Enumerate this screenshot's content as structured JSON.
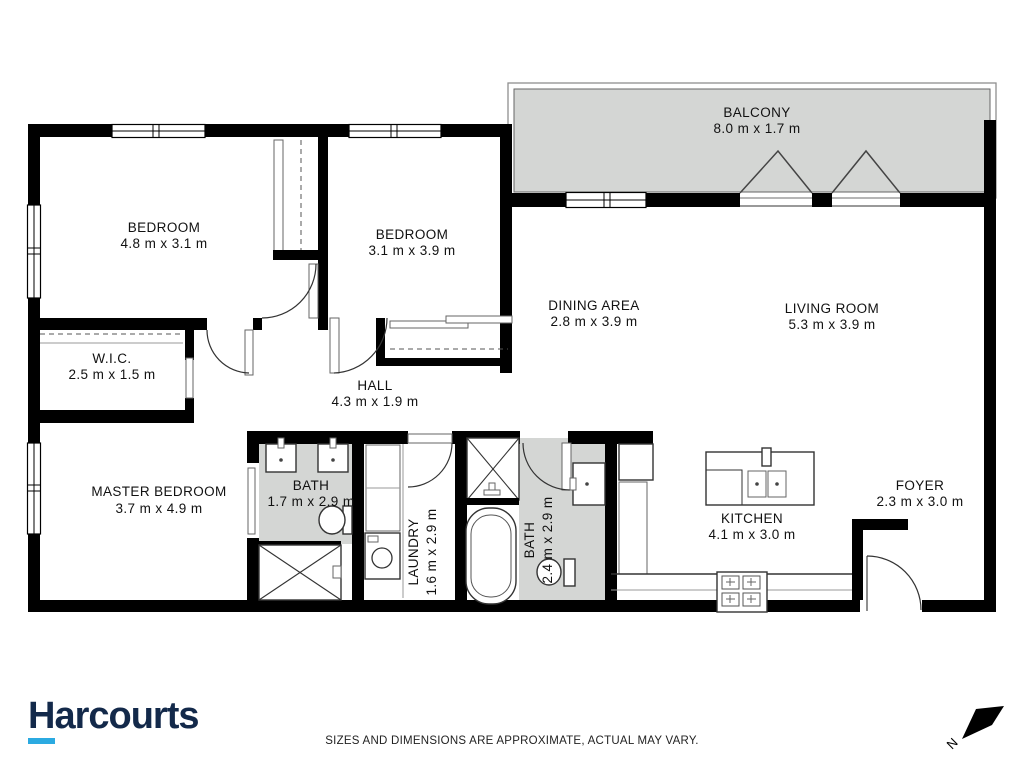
{
  "brand": {
    "logo_text": "Harcourts",
    "logo_color": "#13294a",
    "underline_color": "#2baae1"
  },
  "floorplan": {
    "wall_color": "#000000",
    "shaded_color": "#d4d6d4",
    "rooms": [
      {
        "name": "BALCONY",
        "dims": "8.0 m x 1.7 m"
      },
      {
        "name": "BEDROOM",
        "dims": "4.8 m x 3.1 m"
      },
      {
        "name": "BEDROOM",
        "dims": "3.1 m x 3.9 m"
      },
      {
        "name": "DINING AREA",
        "dims": "2.8 m x 3.9 m"
      },
      {
        "name": "LIVING ROOM",
        "dims": "5.3 m x 3.9 m"
      },
      {
        "name": "W.I.C.",
        "dims": "2.5 m x 1.5 m"
      },
      {
        "name": "HALL",
        "dims": "4.3 m x 1.9 m"
      },
      {
        "name": "MASTER BEDROOM",
        "dims": "3.7 m x 4.9 m"
      },
      {
        "name": "BATH",
        "dims": "1.7 m x 2.9 m"
      },
      {
        "name": "LAUNDRY",
        "dims": "1.6 m x 2.9 m"
      },
      {
        "name": "BATH",
        "dims": "2.4 m x 2.9 m"
      },
      {
        "name": "KITCHEN",
        "dims": "4.1 m x 3.0 m"
      },
      {
        "name": "FOYER",
        "dims": "2.3 m x 3.0 m"
      }
    ]
  },
  "footer": {
    "disclaimer": "SIZES AND DIMENSIONS ARE APPROXIMATE, ACTUAL MAY VARY.",
    "north_label": "N"
  }
}
